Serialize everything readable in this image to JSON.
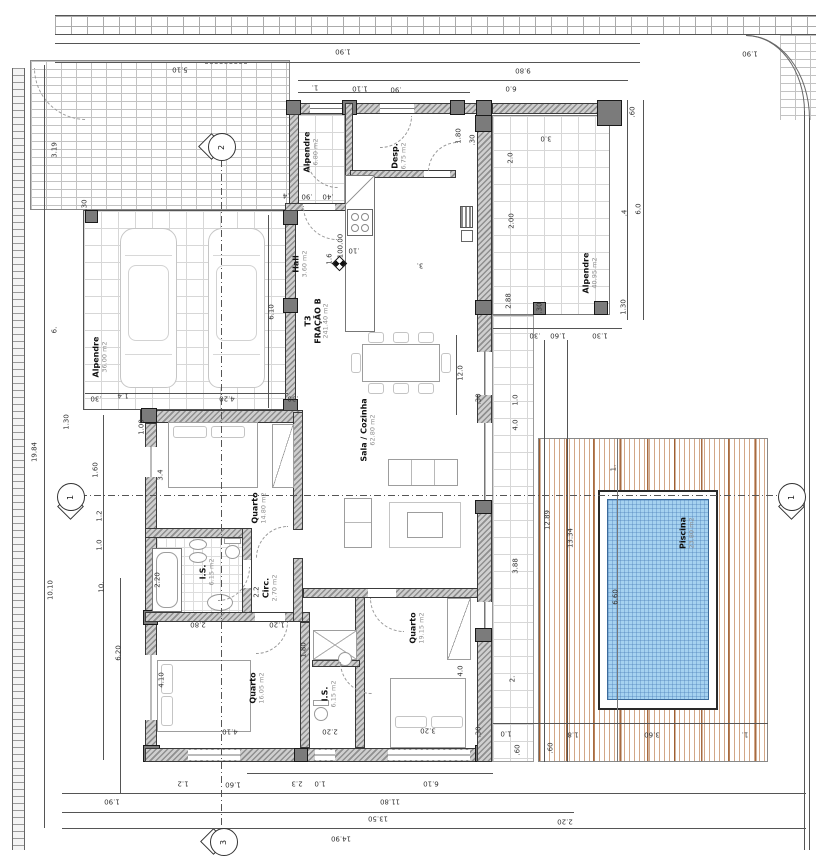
{
  "drawing": {
    "fraction_label": "T3\nFRAÇÃO B",
    "fraction_area": "241.40 m2",
    "level_mark": "100.00"
  },
  "colors": {
    "pool_water": "#a6d2f0",
    "deck_stripe": "#b97c54",
    "wall_hatch": "#8f8f8f"
  },
  "rooms": [
    {
      "name": "Alpendre",
      "area": "6.80 m2",
      "x": 311,
      "y": 152
    },
    {
      "name": "Desp.",
      "area": "6.75 m2",
      "x": 399,
      "y": 156
    },
    {
      "name": "Hall",
      "area": "3.60 m2",
      "x": 300,
      "y": 264
    },
    {
      "name": "Alpendre",
      "area": "36.00 m2",
      "x": 100,
      "y": 357
    },
    {
      "name": "T3\nFRAÇÃO B",
      "area": "241.40 m2",
      "x": 317,
      "y": 321
    },
    {
      "name": "Sala / Cozinha",
      "area": "62.80 m2",
      "x": 368,
      "y": 430
    },
    {
      "name": "Quarto",
      "area": "14.80 m2",
      "x": 259,
      "y": 508
    },
    {
      "name": "I.S.",
      "area": "6.15 m2",
      "x": 207,
      "y": 572
    },
    {
      "name": "Circ.",
      "area": "2.70 m2",
      "x": 270,
      "y": 588
    },
    {
      "name": "Quarto",
      "area": "16.05 m2",
      "x": 257,
      "y": 688
    },
    {
      "name": "I.S.",
      "area": "6.15 m2",
      "x": 329,
      "y": 694
    },
    {
      "name": "Quarto",
      "area": "19.15 m2",
      "x": 417,
      "y": 628
    },
    {
      "name": "Alpendre",
      "area": "40.95 m2",
      "x": 590,
      "y": 273
    },
    {
      "name": "Piscina",
      "area": "23.80 m2",
      "x": 687,
      "y": 533
    }
  ],
  "markers": [
    {
      "n": "2",
      "x": 221,
      "y": 146,
      "dir": "left"
    },
    {
      "n": "3",
      "x": 223,
      "y": 841,
      "dir": "left"
    },
    {
      "n": "1",
      "x": 70,
      "y": 496,
      "dir": "down"
    },
    {
      "n": "1",
      "x": 791,
      "y": 496,
      "dir": "down"
    }
  ],
  "dimensions": [
    {
      "t": "5.10",
      "x": 180,
      "y": 69,
      "r": 180
    },
    {
      "t": "1.90",
      "x": 343,
      "y": 51,
      "r": 180
    },
    {
      "t": "1.90",
      "x": 750,
      "y": 53,
      "r": 180
    },
    {
      "t": "9.80",
      "x": 523,
      "y": 70,
      "r": 180
    },
    {
      "t": "6.0",
      "x": 511,
      "y": 88,
      "r": 180
    },
    {
      "t": "1.",
      "x": 315,
      "y": 87,
      "r": 180
    },
    {
      "t": "1.10",
      "x": 360,
      "y": 88,
      "r": 180
    },
    {
      "t": ".90",
      "x": 396,
      "y": 89,
      "r": 180
    },
    {
      "t": ".60",
      "x": 633,
      "y": 112,
      "r": -90
    },
    {
      "t": "3.0",
      "x": 546,
      "y": 138,
      "r": 180
    },
    {
      "t": "2.0",
      "x": 511,
      "y": 158,
      "r": -90
    },
    {
      "t": "2.00",
      "x": 512,
      "y": 221,
      "r": -90
    },
    {
      "t": "2.88",
      "x": 509,
      "y": 301,
      "r": -90
    },
    {
      "t": "6.0",
      "x": 639,
      "y": 209,
      "r": -90
    },
    {
      "t": ".4",
      "x": 625,
      "y": 213,
      "r": -90
    },
    {
      "t": "1.30",
      "x": 624,
      "y": 307,
      "r": -90
    },
    {
      "t": ".30",
      "x": 540,
      "y": 308,
      "r": -90
    },
    {
      "t": "1.80",
      "x": 459,
      "y": 136,
      "r": -90
    },
    {
      "t": ".30",
      "x": 473,
      "y": 140,
      "r": -90
    },
    {
      "t": "3.19",
      "x": 55,
      "y": 150,
      "r": -90
    },
    {
      "t": ".4",
      "x": 286,
      "y": 195,
      "r": 180
    },
    {
      "t": ".90",
      "x": 307,
      "y": 196,
      "r": 180
    },
    {
      "t": ".40",
      "x": 328,
      "y": 196,
      "r": 180
    },
    {
      "t": "6.10",
      "x": 272,
      "y": 312,
      "r": -90
    },
    {
      "t": "4.20",
      "x": 227,
      "y": 398,
      "r": 180
    },
    {
      "t": "1.4",
      "x": 123,
      "y": 395,
      "r": 180
    },
    {
      "t": ".30",
      "x": 96,
      "y": 398,
      "r": 180
    },
    {
      "t": ".30",
      "x": 293,
      "y": 398,
      "r": 180
    },
    {
      "t": "6.",
      "x": 55,
      "y": 330,
      "r": -90
    },
    {
      "t": ".30",
      "x": 85,
      "y": 205,
      "r": -90
    },
    {
      "t": "1.30",
      "x": 67,
      "y": 422,
      "r": -90
    },
    {
      "t": "19.84",
      "x": 35,
      "y": 452,
      "r": -90
    },
    {
      "t": "10.10",
      "x": 51,
      "y": 590,
      "r": -90
    },
    {
      "t": "10.",
      "x": 102,
      "y": 587,
      "r": -90
    },
    {
      "t": "6.20",
      "x": 119,
      "y": 653,
      "r": -90
    },
    {
      "t": "1.60",
      "x": 96,
      "y": 470,
      "r": -90
    },
    {
      "t": "1.2",
      "x": 100,
      "y": 516,
      "r": -90
    },
    {
      "t": "1.0",
      "x": 100,
      "y": 545,
      "r": -90
    },
    {
      "t": "1.00",
      "x": 142,
      "y": 427,
      "r": -90
    },
    {
      "t": "3.4",
      "x": 161,
      "y": 475,
      "r": -90
    },
    {
      "t": "100.00",
      "x": 341,
      "y": 246,
      "r": -90
    },
    {
      "t": "1.6",
      "x": 330,
      "y": 259,
      "r": -90
    },
    {
      "t": ".10",
      "x": 354,
      "y": 250,
      "r": 180
    },
    {
      "t": "3.",
      "x": 420,
      "y": 265,
      "r": 180
    },
    {
      "t": "12.0",
      "x": 461,
      "y": 373,
      "r": -90
    },
    {
      "t": "2.20",
      "x": 158,
      "y": 580,
      "r": -90
    },
    {
      "t": "2.2",
      "x": 257,
      "y": 592,
      "r": -90
    },
    {
      "t": "1.20",
      "x": 277,
      "y": 624,
      "r": 180
    },
    {
      "t": "2.80",
      "x": 198,
      "y": 624,
      "r": 180
    },
    {
      "t": "4.10",
      "x": 162,
      "y": 680,
      "r": -90
    },
    {
      "t": "4.10",
      "x": 230,
      "y": 731,
      "r": 180
    },
    {
      "t": "2.20",
      "x": 330,
      "y": 731,
      "r": 180
    },
    {
      "t": "1.80",
      "x": 304,
      "y": 650,
      "r": -90
    },
    {
      "t": "4.0",
      "x": 461,
      "y": 671,
      "r": -90
    },
    {
      "t": "3.20",
      "x": 428,
      "y": 730,
      "r": 180
    },
    {
      "t": ".30",
      "x": 479,
      "y": 399,
      "r": -90
    },
    {
      "t": "1.0",
      "x": 516,
      "y": 400,
      "r": -90
    },
    {
      "t": "4.0",
      "x": 516,
      "y": 425,
      "r": -90
    },
    {
      "t": "3.88",
      "x": 516,
      "y": 566,
      "r": -90
    },
    {
      "t": "2.",
      "x": 513,
      "y": 679,
      "r": -90
    },
    {
      "t": ".30",
      "x": 535,
      "y": 335,
      "r": 180
    },
    {
      "t": "1.60",
      "x": 558,
      "y": 335,
      "r": 180
    },
    {
      "t": "1.30",
      "x": 600,
      "y": 335,
      "r": 180
    },
    {
      "t": "12.89",
      "x": 548,
      "y": 520,
      "r": -90
    },
    {
      "t": "13.34",
      "x": 571,
      "y": 538,
      "r": -90
    },
    {
      "t": "1.",
      "x": 614,
      "y": 468,
      "r": -90
    },
    {
      "t": "6.60",
      "x": 616,
      "y": 597,
      "r": -90
    },
    {
      "t": ".30",
      "x": 479,
      "y": 732,
      "r": -90
    },
    {
      "t": "1.0",
      "x": 506,
      "y": 733,
      "r": 180
    },
    {
      "t": ".60",
      "x": 518,
      "y": 750,
      "r": -90
    },
    {
      "t": ".60",
      "x": 551,
      "y": 748,
      "r": -90
    },
    {
      "t": "1.8",
      "x": 573,
      "y": 734,
      "r": 180
    },
    {
      "t": "3.60",
      "x": 652,
      "y": 734,
      "r": 180
    },
    {
      "t": "1.",
      "x": 745,
      "y": 734,
      "r": 180
    },
    {
      "t": "1.2",
      "x": 183,
      "y": 783,
      "r": 180
    },
    {
      "t": "1.60",
      "x": 233,
      "y": 784,
      "r": 180
    },
    {
      "t": "2.3",
      "x": 297,
      "y": 783,
      "r": 180
    },
    {
      "t": "1.0",
      "x": 320,
      "y": 783,
      "r": 180
    },
    {
      "t": "6.10",
      "x": 431,
      "y": 783,
      "r": 180
    },
    {
      "t": "1.90",
      "x": 112,
      "y": 801,
      "r": 180
    },
    {
      "t": "11.80",
      "x": 390,
      "y": 801,
      "r": 180
    },
    {
      "t": "13.50",
      "x": 378,
      "y": 818,
      "r": 180
    },
    {
      "t": "2.20",
      "x": 565,
      "y": 821,
      "r": 180
    },
    {
      "t": "14.90",
      "x": 341,
      "y": 838,
      "r": 180
    }
  ]
}
